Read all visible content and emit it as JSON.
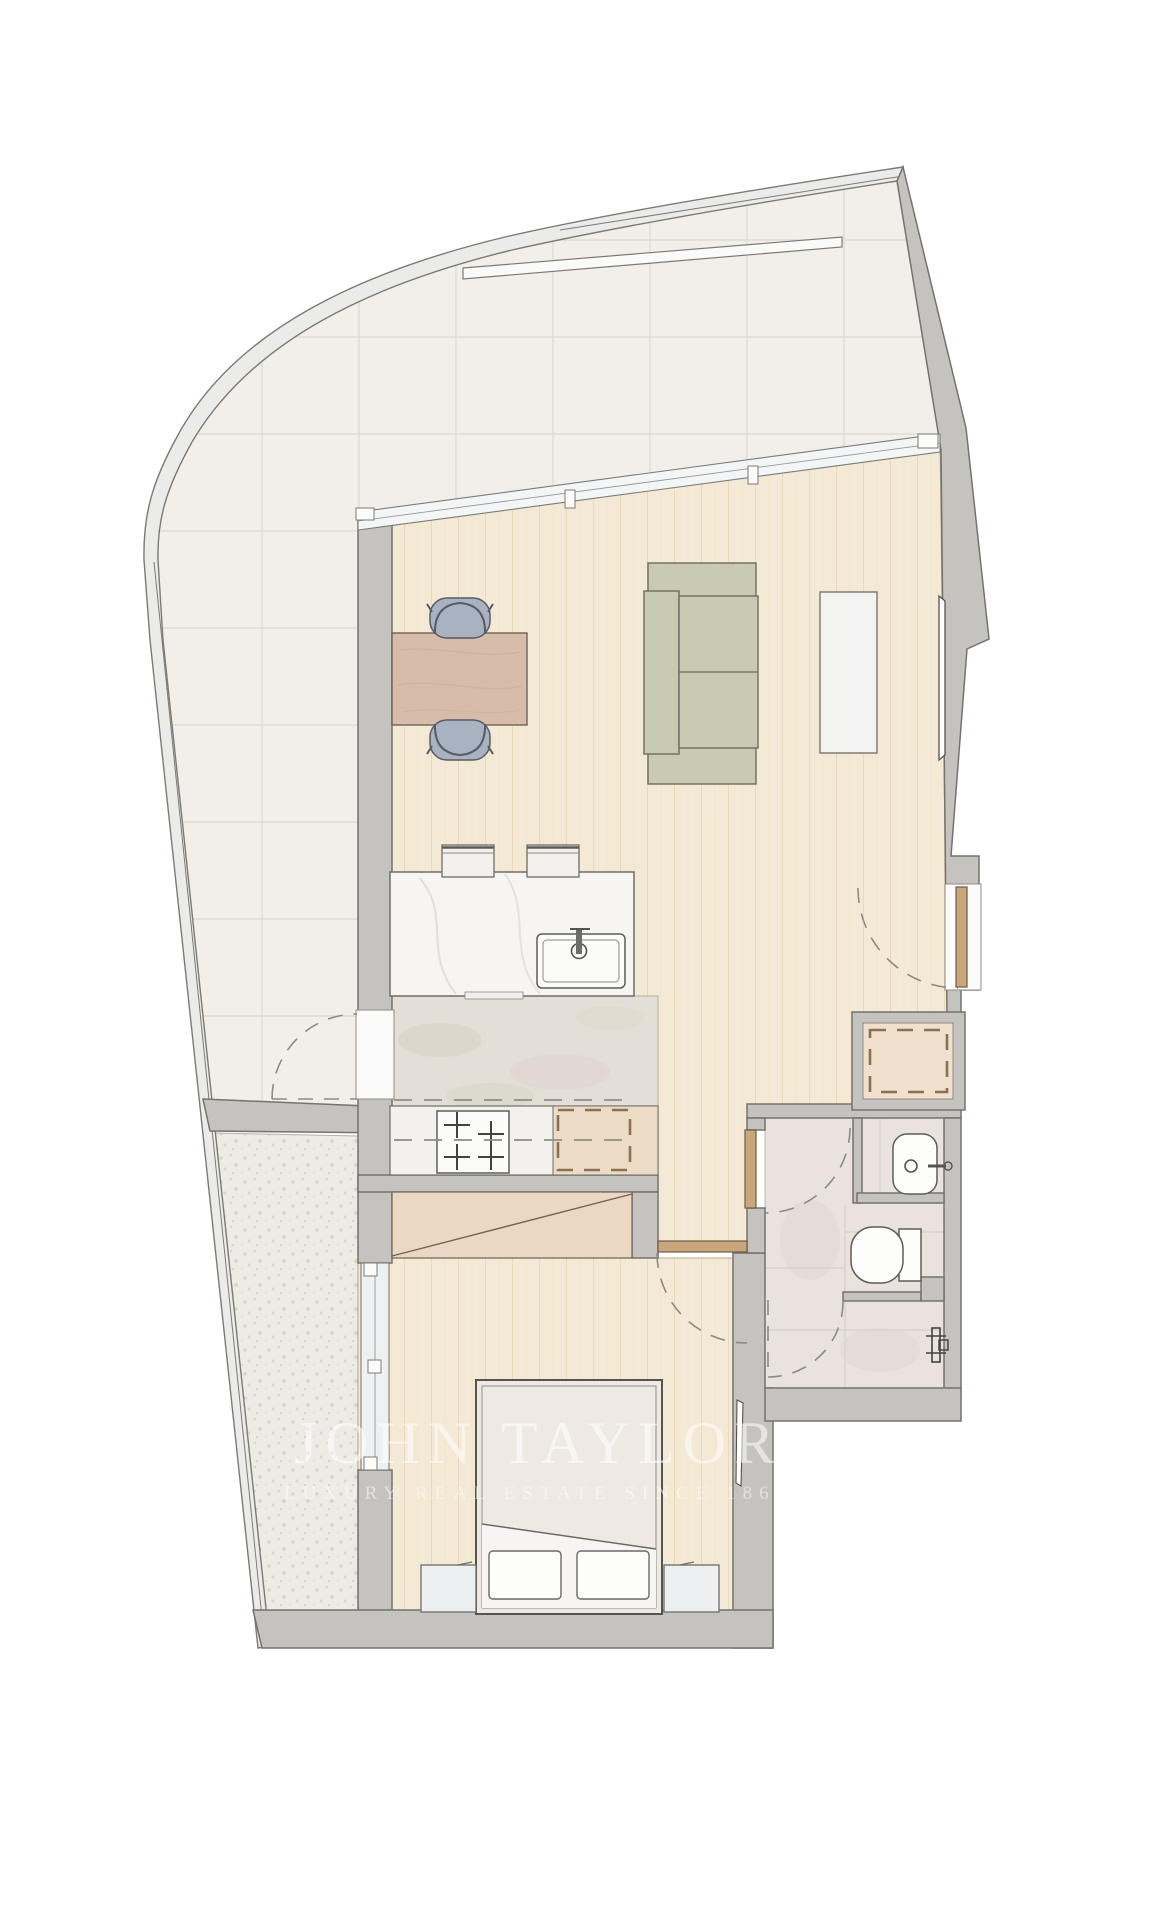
{
  "watermark": {
    "title": "JOHN TAYLOR",
    "subtitle": "LUXURY REAL ESTATE SINCE 1864"
  },
  "palette": {
    "background": "#ffffff",
    "wall_gray": "#c5c3c0",
    "wall_outline": "#75736c",
    "terrace_tile": "#f2efeb",
    "terrace_gravel": "#edebe6",
    "wood_floor": "#f3e9d4",
    "kitchen_stone": "#e3dfd7",
    "bathroom_tile": "#e9e2de",
    "marble_counter": "#f6f5f2",
    "table_wood": "#d8bcaa",
    "chair_upholstery": "#a9b2c1",
    "sofa_fabric": "#c9cab2",
    "closet_tan": "#ecd8c2",
    "door_leaf": "#c9a67b",
    "watermark_white": "rgba(255,255,255,0.55)"
  },
  "plan": {
    "type": "apartment-floor-plan",
    "depicted_rooms": [
      "wrap-around terrace (tiled)",
      "terrace (gravel strip)",
      "living-dining room",
      "open kitchen",
      "entry hall",
      "bathroom",
      "bedroom"
    ],
    "depicted_items": [
      "dining-table",
      "dining-chair-top",
      "dining-chair-bottom",
      "sofa",
      "tv-console",
      "wall-tv",
      "kitchen-island",
      "island-sink",
      "bar-stool-1",
      "bar-stool-2",
      "cooktop-4-burners",
      "fridge-dashed",
      "washer-closet-dashed",
      "wardrobe-diagonal",
      "bed",
      "pillow-1",
      "pillow-2",
      "nightstand-left",
      "nightstand-right",
      "mirror",
      "washbasin",
      "toilet",
      "shower",
      "entry-door-swing",
      "bedroom-door-swing",
      "bathroom-door-swing",
      "terrace-door-swing",
      "shower-door-swing",
      "living-room-window-band",
      "bedroom-window"
    ]
  }
}
